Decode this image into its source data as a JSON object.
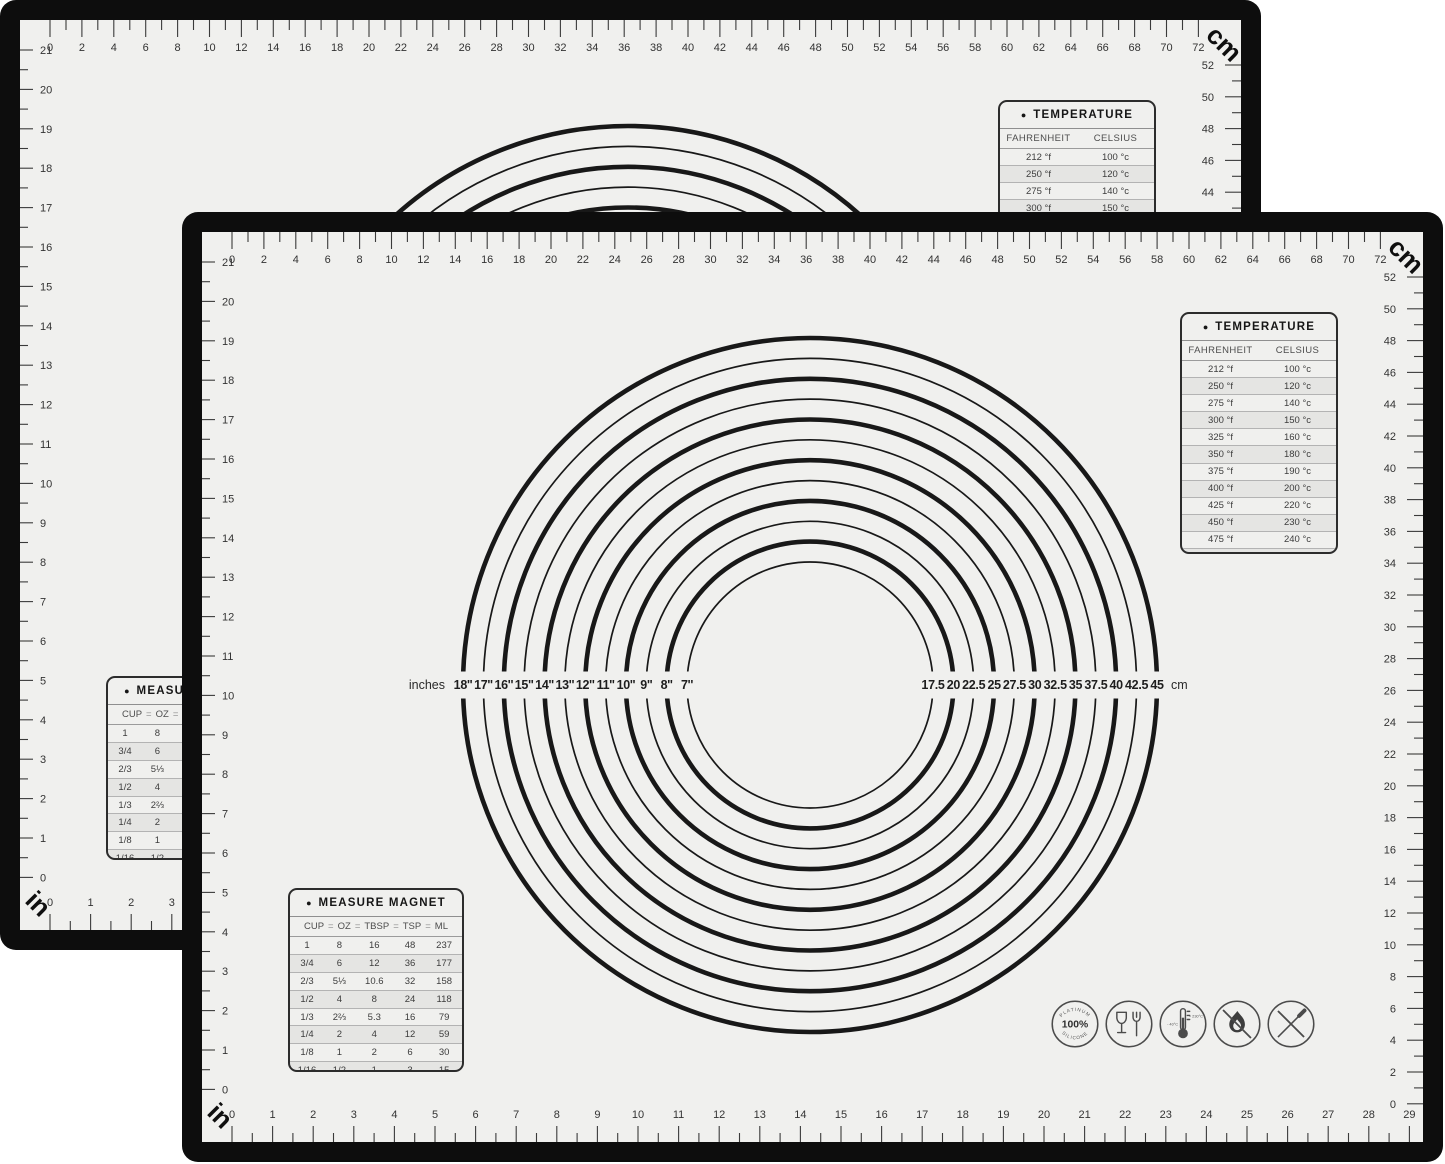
{
  "page": {
    "background": "#ffffff"
  },
  "mat": {
    "surface_color": "#f0f0ee",
    "border_color": "#0d0d0d",
    "table_bullet": "●",
    "top_ruler": {
      "unit_label": "cm",
      "labels": [
        "0",
        "2",
        "4",
        "6",
        "8",
        "10",
        "12",
        "14",
        "16",
        "18",
        "20",
        "22",
        "24",
        "26",
        "28",
        "30",
        "32",
        "34",
        "36",
        "38",
        "40",
        "42",
        "44",
        "46",
        "48",
        "50",
        "52",
        "54",
        "56",
        "58",
        "60",
        "62",
        "64",
        "66",
        "68",
        "70",
        "72"
      ]
    },
    "right_ruler": {
      "labels": [
        "52",
        "50",
        "48",
        "46",
        "44",
        "42",
        "40",
        "38",
        "36",
        "34",
        "32",
        "30",
        "28",
        "26",
        "24",
        "22",
        "20",
        "18",
        "16",
        "14",
        "12",
        "10",
        "8",
        "6",
        "4",
        "2",
        "0"
      ]
    },
    "left_ruler": {
      "labels": [
        "21",
        "20",
        "19",
        "18",
        "17",
        "16",
        "15",
        "14",
        "13",
        "12",
        "11",
        "10",
        "9",
        "8",
        "7",
        "6",
        "5",
        "4",
        "3",
        "2",
        "1",
        "0"
      ]
    },
    "bottom_ruler": {
      "unit_label": "in",
      "labels": [
        "0",
        "1",
        "2",
        "3",
        "4",
        "5",
        "6",
        "7",
        "8",
        "9",
        "10",
        "11",
        "12",
        "13",
        "14",
        "15",
        "16",
        "17",
        "18",
        "19",
        "20",
        "21",
        "22",
        "23",
        "24",
        "25",
        "26",
        "27",
        "28",
        "29"
      ]
    },
    "circle_gauge": {
      "left_caption": "inches",
      "inch_labels": [
        "18''",
        "17''",
        "16''",
        "15''",
        "14''",
        "13''",
        "12''",
        "11''",
        "10''",
        "9''",
        "8''",
        "7''"
      ],
      "cm_labels": [
        "17.5",
        "20",
        "22.5",
        "25",
        "27.5",
        "30",
        "32.5",
        "35",
        "37.5",
        "40",
        "42.5",
        "45"
      ],
      "right_caption": "cm"
    },
    "temperature_table": {
      "title": "TEMPERATURE",
      "columns": [
        "FAHRENHEIT",
        "CELSIUS"
      ],
      "rows": [
        [
          "212 °f",
          "100 °c"
        ],
        [
          "250 °f",
          "120 °c"
        ],
        [
          "275 °f",
          "140 °c"
        ],
        [
          "300 °f",
          "150 °c"
        ],
        [
          "325 °f",
          "160 °c"
        ],
        [
          "350 °f",
          "180 °c"
        ],
        [
          "375 °f",
          "190 °c"
        ],
        [
          "400 °f",
          "200 °c"
        ],
        [
          "425 °f",
          "220 °c"
        ],
        [
          "450 °f",
          "230 °c"
        ],
        [
          "475 °f",
          "240 °c"
        ],
        [
          "500 °f",
          "260 °c"
        ]
      ]
    },
    "measure_table": {
      "title": "MEASURE MAGNET",
      "equals": "=",
      "columns": [
        "CUP",
        "OZ",
        "TBSP",
        "TSP",
        "ML"
      ],
      "rows": [
        [
          "1",
          "8",
          "16",
          "48",
          "237"
        ],
        [
          "3/4",
          "6",
          "12",
          "36",
          "177"
        ],
        [
          "2/3",
          "5⅓",
          "10.6",
          "32",
          "158"
        ],
        [
          "1/2",
          "4",
          "8",
          "24",
          "118"
        ],
        [
          "1/3",
          "2⅔",
          "5.3",
          "16",
          "79"
        ],
        [
          "1/4",
          "2",
          "4",
          "12",
          "59"
        ],
        [
          "1/8",
          "1",
          "2",
          "6",
          "30"
        ],
        [
          "1/16",
          "1/2",
          "1",
          "3",
          "15"
        ]
      ]
    },
    "badges": {
      "platinum_top": "PLATINUM",
      "platinum_center": "100%",
      "platinum_bottom": "SILICONE",
      "temp_min": "- 40°C",
      "temp_max": "+ 230°C"
    }
  }
}
